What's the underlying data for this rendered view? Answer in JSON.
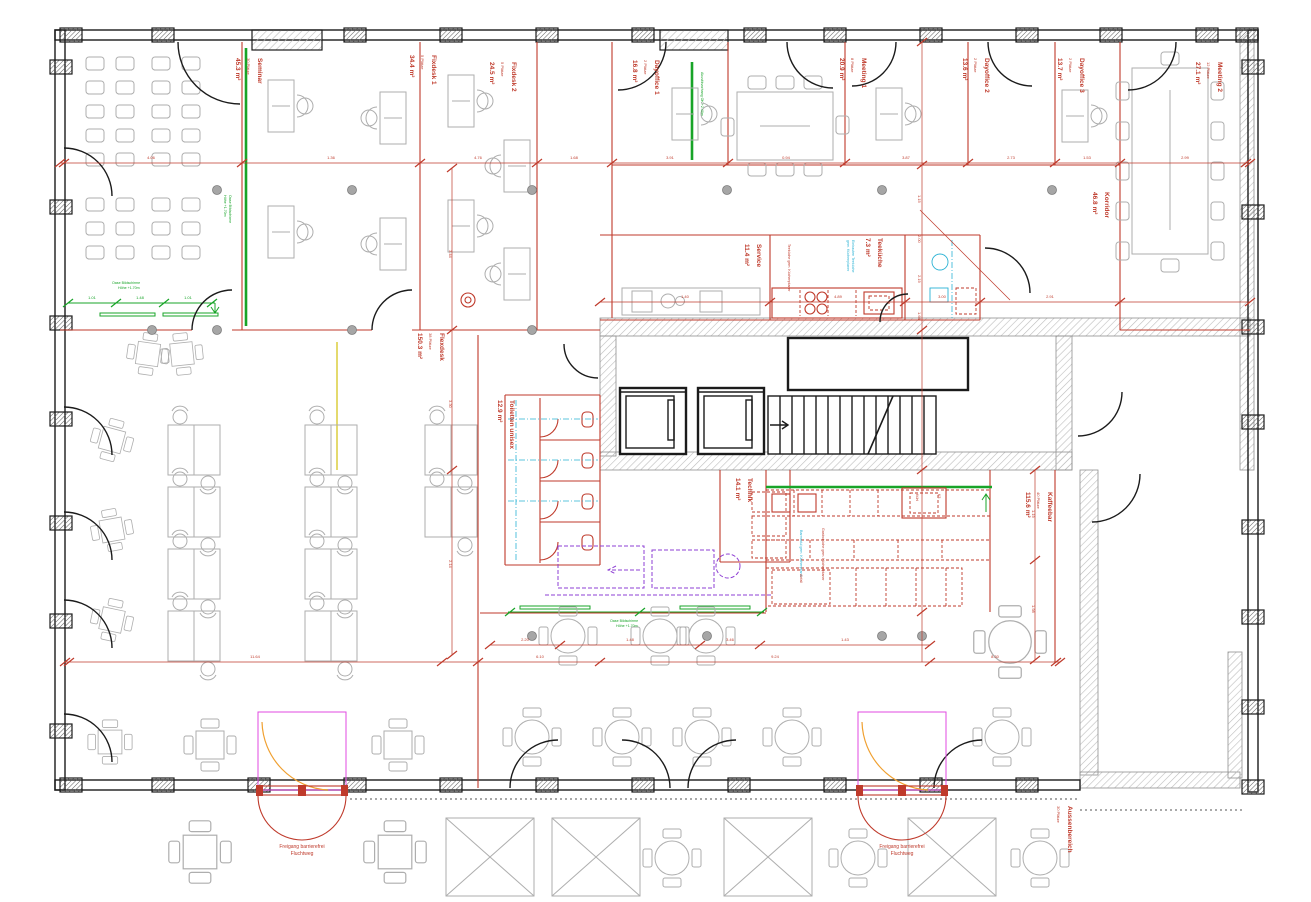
{
  "plan": {
    "type": "architectural-floor-plan",
    "language": "de"
  },
  "rooms": [
    {
      "name": "Seminar",
      "capacity": "30 Plätze",
      "area": "45.3 m²"
    },
    {
      "name": "Fixdesk 1",
      "capacity": "5 Plätze",
      "area": "34.4 m²"
    },
    {
      "name": "Fixdesk 2",
      "capacity": "5 Plätze",
      "area": "24.5 m²"
    },
    {
      "name": "Dayoffice 1",
      "capacity": "2 Plätze",
      "area": "16.8 m²"
    },
    {
      "name": "Meeting 1",
      "capacity": "8 Plätze",
      "area": "20.9 m²"
    },
    {
      "name": "Dayoffice 2",
      "capacity": "2 Plätze",
      "area": "13.6 m²"
    },
    {
      "name": "Dayoffice 3",
      "capacity": "2 Plätze",
      "area": "13.7 m²"
    },
    {
      "name": "Meeting 2",
      "capacity": "12 Plätze",
      "area": "27.1 m²"
    },
    {
      "name": "Korridor",
      "capacity": "",
      "area": "46.8 m²"
    },
    {
      "name": "Service",
      "capacity": "",
      "area": "11.4 m²"
    },
    {
      "name": "Teeküche",
      "capacity": "",
      "area": "7.3 m²"
    },
    {
      "name": "Flexdesk",
      "capacity": "38 Plätze",
      "area": "150.3 m²"
    },
    {
      "name": "Toiletten unisex",
      "capacity": "",
      "area": "12.9 m²"
    },
    {
      "name": "Technik",
      "capacity": "",
      "area": "14.1 m²"
    },
    {
      "name": "Kaffeebar",
      "capacity": "40 Plätze",
      "area": "115.6 m²"
    },
    {
      "name": "Aussenbereich",
      "capacity": "30 Plätze",
      "area": ""
    }
  ],
  "annotations": {
    "exit": {
      "l1": "Freigang barrierefrei",
      "l2": "Fluchtweg"
    },
    "oase": {
      "l1": "Oase Bildschirme",
      "l2": "Höhe +1.70m"
    },
    "curtain": "Akustikvorhang OK +2.40m",
    "kitchen_note": "Teeküche gem. Küchenplaner",
    "tk_cyan": {
      "l1": "Einbauten Teeküche",
      "l2": "gem. Küchenplaner"
    },
    "bar_note": "Gastroküche gem. Küchenplaner",
    "bar_cyan": "Barmodul gem. Küchenplaner",
    "counter": {
      "k1": "Kühl",
      "k2": "K3",
      "k3": "Abfall"
    }
  },
  "dims": {
    "top": [
      "4.06",
      "1.36",
      "4.76",
      "1.68",
      "3.91",
      "0.94",
      "3.87",
      "2.73",
      "1.53",
      "2.99"
    ],
    "service": [
      "1.40",
      "4.89",
      "3.00",
      "2.91"
    ],
    "flex_v": [
      "3.44",
      "3.30",
      "2.14"
    ],
    "right_v": [
      "1.15",
      "2.00",
      "2.19",
      "1.66"
    ],
    "bottom": [
      "11.64",
      "6.10",
      "9.24",
      "8.30"
    ],
    "bar": [
      "2.20",
      "1.48",
      "3.46",
      "1.43"
    ],
    "kaffee_v": [
      "1.19",
      "1.98"
    ],
    "green": [
      "1.01",
      "1.48",
      "1.01"
    ]
  },
  "colors": {
    "wall": "#1b1b1b",
    "furniture": "#aeaeae",
    "dimension_red": "#bf3a2b",
    "green": "#18a428",
    "magenta": "#e14ae1",
    "cyan": "#2ab2d4",
    "purple": "#8e3fd4",
    "orange": "#f0a030",
    "yellow": "#ddd04a",
    "hatch": "#bdbdbd"
  }
}
